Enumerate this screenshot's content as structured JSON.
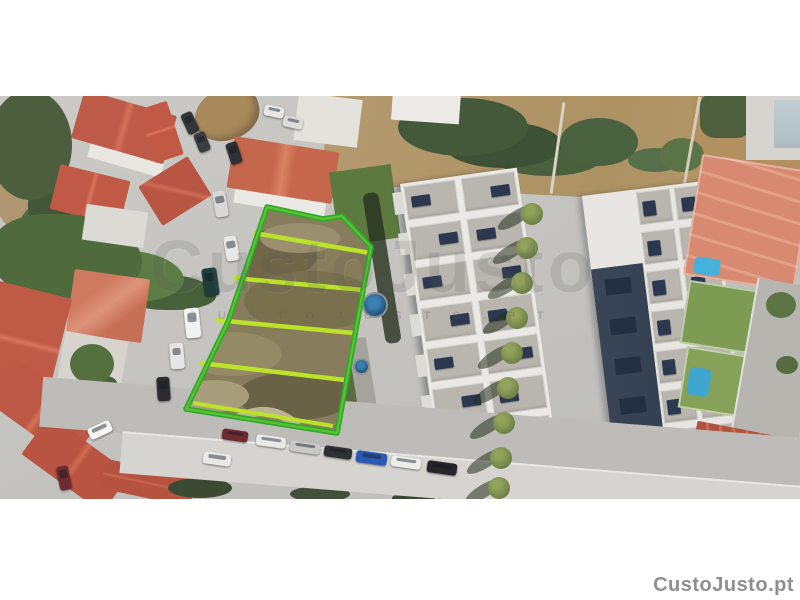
{
  "watermark_center": {
    "title": "CustoJusto",
    "tagline": "CUSTOJUSTO.PT"
  },
  "logo": {
    "text": "CustoJusto.pt"
  },
  "plot_annotation": {
    "subdivisions": 4,
    "outline_color": "#2fa82f",
    "outline_highlight_color": "#5ac42d",
    "divider_color": "#bce32a"
  },
  "colors": {
    "watermark_gray": "#5a5a5a",
    "logo_gray": "#8f8f8f",
    "letterbox_white": "#ffffff"
  }
}
